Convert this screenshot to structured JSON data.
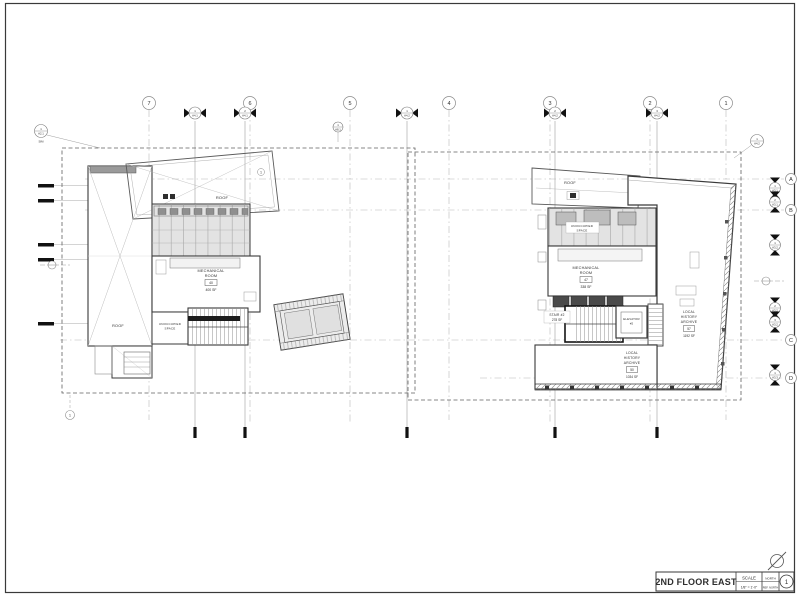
{
  "sheet": {
    "title": "2ND FLOOR EAST",
    "scale_label": "SCALE",
    "scale_value": "1/8\" = 1'-0\"",
    "north_label": "NORTH",
    "ref_north_label": "REF. NORTH",
    "sheet_number": "1"
  },
  "grid": {
    "columns": [
      {
        "label": "7"
      },
      {
        "label": "6"
      },
      {
        "label": "5"
      },
      {
        "label": "4"
      },
      {
        "label": "3"
      },
      {
        "label": "2"
      },
      {
        "label": "1"
      }
    ],
    "rows": [
      {
        "label": "A"
      },
      {
        "label": "B"
      },
      {
        "label": "C"
      },
      {
        "label": "D"
      }
    ]
  },
  "section_markers": {
    "top": [
      {
        "num": "1",
        "sheet": "A4.1"
      },
      {
        "num": "2",
        "sheet": "A4.1"
      },
      {
        "num": "1",
        "sheet": "A4.2"
      },
      {
        "num": "2",
        "sheet": "A4.2"
      },
      {
        "num": "3",
        "sheet": "A4.2"
      }
    ],
    "right": [
      {
        "num": "1",
        "sheet": "A3.1"
      },
      {
        "num": "2",
        "sheet": "A3.1"
      },
      {
        "num": "1",
        "sheet": "A3.2"
      },
      {
        "num": "2",
        "sheet": "A3.2"
      },
      {
        "num": "3",
        "sheet": "A3.2"
      },
      {
        "num": "1",
        "sheet": "A3.3"
      }
    ],
    "callout_mid": {
      "num": "1",
      "sheet": "A8.1"
    },
    "callout_right": {
      "num": "1",
      "sheet": "A4.2"
    },
    "callout_left": {
      "num": "1",
      "sheet": "A2.1",
      "sim": "SIM"
    },
    "keynote_bottom": "1"
  },
  "left_plan": {
    "roof_label_top": "ROOF",
    "roof_tag": "1",
    "roof_label_strip": "ROOF",
    "mech_room": {
      "line1": "MECHANICAL",
      "line2": "ROOM",
      "number": "40",
      "area": "400 SF"
    },
    "unoccupied": {
      "line1": "UNOCCUPIED",
      "line2": "SPACE"
    }
  },
  "right_plan": {
    "roof_label": "ROOF",
    "unoccupied": {
      "line1": "UNOCCUPIED",
      "line2": "SPACE"
    },
    "mech_room": {
      "line1": "MECHANICAL",
      "line2": "ROOM",
      "number": "47",
      "area": "338 SF"
    },
    "stair": {
      "label": "STAIR #2",
      "area": "278 SF"
    },
    "elevator": {
      "line1": "ELEVATOR",
      "line2": "#2"
    },
    "archive_east": {
      "line1": "LOCAL",
      "line2": "HISTORY",
      "line3": "ARCHIVE",
      "number": "57",
      "area": "1192 SF"
    },
    "archive_south": {
      "line1": "LOCAL",
      "line2": "HISTORY",
      "line3": "ARCHIVE",
      "number": "50",
      "area": "1034 SF"
    }
  }
}
